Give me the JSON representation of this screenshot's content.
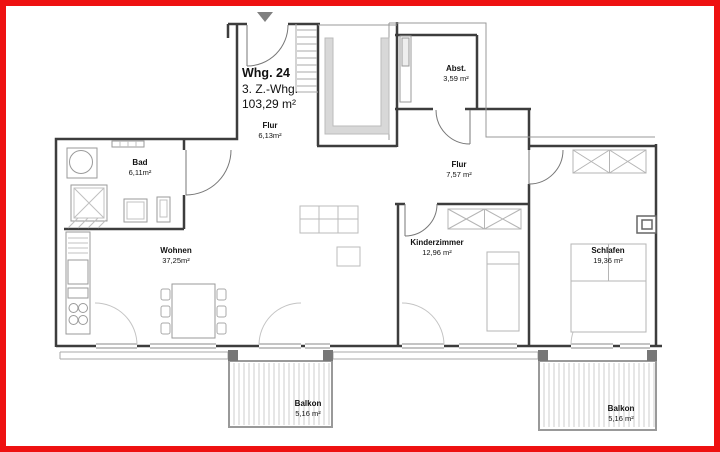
{
  "apartment": {
    "unit": "Whg. 24",
    "type": "3. Z.-Whg.",
    "total_area": "103,29 m²"
  },
  "rooms": {
    "flur1": {
      "name": "Flur",
      "area": "6,13m²"
    },
    "bad": {
      "name": "Bad",
      "area": "6,11m²"
    },
    "abst": {
      "name": "Abst.",
      "area": "3,59 m²"
    },
    "flur2": {
      "name": "Flur",
      "area": "7,57 m²"
    },
    "wohnen": {
      "name": "Wohnen",
      "area": "37,25m²"
    },
    "kinderzimmer": {
      "name": "Kinderzimmer",
      "area": "12,96 m²"
    },
    "schlafen": {
      "name": "Schlafen",
      "area": "19,36 m²"
    },
    "balkon1": {
      "name": "Balkon",
      "area": "5,16 m²"
    },
    "balkon2": {
      "name": "Balkon",
      "area": "5,16 m²"
    }
  },
  "icons": {
    "entrance_arrow": "▼"
  },
  "colors": {
    "frame_border": "#ee1111",
    "walls": "#3d3d3d",
    "thin_lines": "#999999",
    "furniture_outline": "#9a9a9a",
    "light_detail": "#c6c6c6",
    "stair_void_fill": "#d8d8d8",
    "arrow": "#808080",
    "text": "#111111"
  }
}
